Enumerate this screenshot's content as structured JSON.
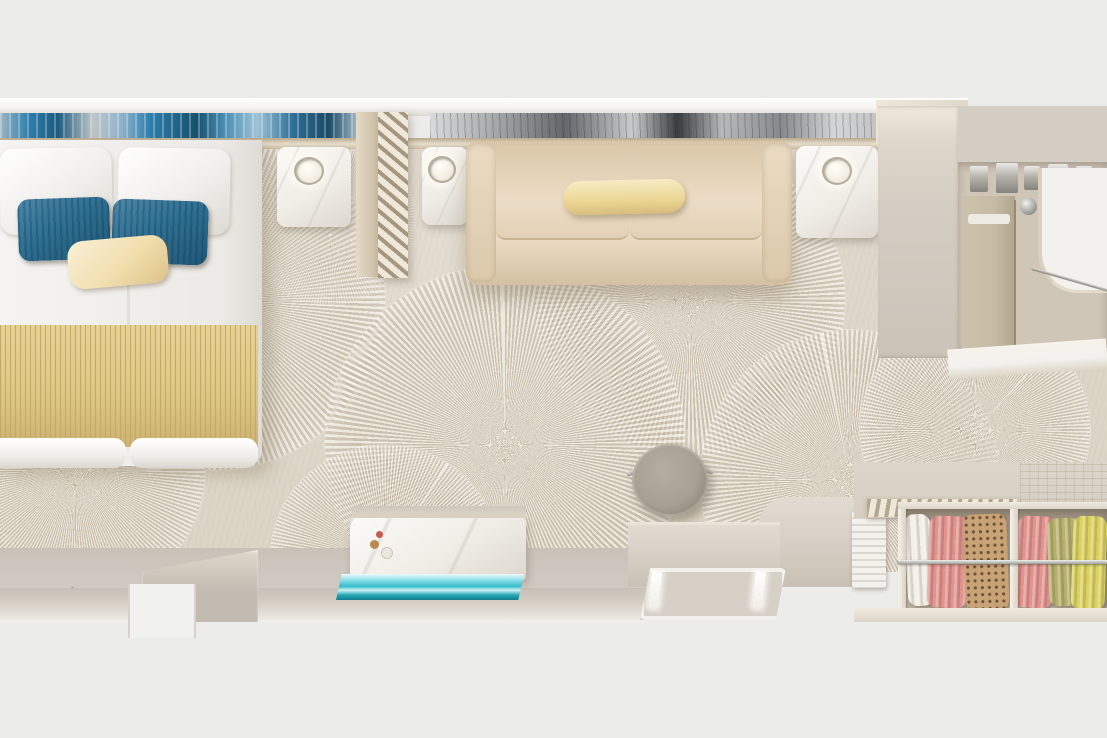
{
  "scene": {
    "type": "photorealistic 3d render, top-down cutaway view",
    "subject": "cruise-ship stateroom / hotel cabin floor plan",
    "areas": [
      "sleeping area: double bed with white bedding, two teal pillows, one cream pillow, gold ribbed runner at foot",
      "headboard wall with blue abstract art panel (left) and silver abstract art panel (right)",
      "two white marble nightstands with glowing lamps beside bed, slatted room-divider screen",
      "living area: cream two-seat sofa with pale-yellow bolster pillow and marble side table with lamp",
      "beige carpet with large radial fan / starburst medallion pattern",
      "vanity desk with white marble front, small decor, turquoise glass bench",
      "round taupe stool with chrome handles",
      "greige sideboard counter with illuminated luggage tray and white vent panel",
      "open wardrobe with chrome rail and hanging clothes: white, pink, leopard-print, pink, olive, yellow",
      "bathroom (top right) with beige vanity, chrome fixtures and white curved counter",
      "entry area at bottom with door opening in grey wall"
    ]
  },
  "objects": {
    "bed": {
      "bedding": "white",
      "pillows": [
        "white",
        "white",
        "teal",
        "teal",
        "cream"
      ],
      "foot_runner": "gold ribbed"
    },
    "sofa": {
      "upholstery": "cream",
      "bolster_pillow": "pale yellow",
      "seats": 2
    },
    "nightstands": {
      "count": 3,
      "material": "white marble",
      "lamps": "lit, warm glow"
    },
    "screen_divider": {
      "style": "diagonal slats",
      "color": "beige"
    },
    "stool": {
      "shape": "round",
      "color": "taupe",
      "accents": "chrome"
    },
    "desk": {
      "front": "white marble with grey veining",
      "bench": "turquoise glass",
      "decor": [
        "gold",
        "red",
        "white"
      ]
    },
    "wardrobe": {
      "rail": "chrome",
      "garments": [
        "white",
        "pink",
        "leopard",
        "pink",
        "olive",
        "yellow"
      ],
      "hangers": "wood"
    },
    "bathroom": {
      "vanity": "beige",
      "counter": "white curved",
      "fixtures": "chrome"
    },
    "carpet": {
      "pattern": "radial fan medallions",
      "tone": "warm beige"
    },
    "entry": {
      "door_opening": "bottom-left wall",
      "floor": "hard greige"
    }
  },
  "colors": {
    "page_bg": "#ecedea",
    "wall_white": "#f4f3f0",
    "wall_gray": "#d4cdc3",
    "wall_stub": "#c2bbb1",
    "floor_hard": "#cfc8c0",
    "art_blue1": "#2e7fae",
    "art_blue2": "#16506e",
    "art_dark": "#3a3d40",
    "carpet_base": "#dcd4c5",
    "bed_white": "#f5f4f2",
    "pillow_teal": "#2f6f92",
    "pillow_teal_dark": "#1d5777",
    "pillow_cream": "#f1dfae",
    "blanket_gold": "#dfc887",
    "blanket_stripe": "#c3a866",
    "marble_white": "#f0ede7",
    "lamp_glow": "#fffdf4",
    "chrome": "#b5b1a9",
    "screen_beige": "#cbbda4",
    "screen_slat": "#a6977e",
    "sofa_cream": "#e6d5bb",
    "bolster_yellow": "#ecd694",
    "stool_taupe": "#a79f91",
    "stool_dark": "#857d6f",
    "glass_teal": "#35bcc9",
    "glass_dark": "#117e8d",
    "counter_greige": "#d8d1c7",
    "tray_frame": "#f3f1ec",
    "tray_inner": "#d7d0c6",
    "closet_top": "#d6cec2",
    "closet_interior": "#b5aa99",
    "garment_white": "#f4f0e7",
    "garment_pink": "#e2938d",
    "garment_leopard": "#c9a276",
    "garment_spot": "#6a5036",
    "garment_olive": "#b7b06b",
    "garment_yellow": "#dcd25f",
    "hanger_wood": "#9a7450",
    "bath_wall": "#cfc6b8",
    "bath_vanity": "#c6bba6",
    "bath_white": "#f2f1ed"
  }
}
